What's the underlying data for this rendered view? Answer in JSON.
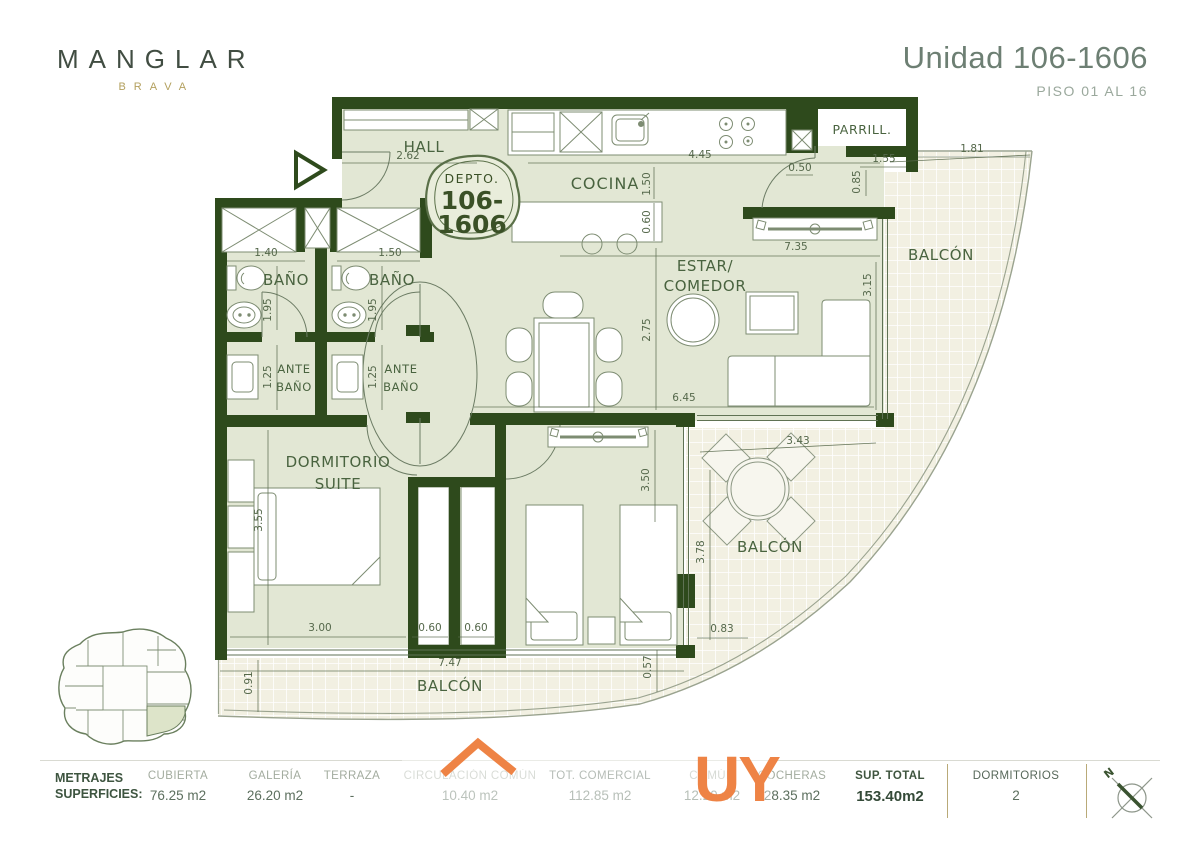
{
  "brand": {
    "name": "MANGLAR",
    "tagline": "BRAVA"
  },
  "header": {
    "title": "Unidad 106-1606",
    "subtitle": "PISO 01 AL 16"
  },
  "badge": {
    "prefix": "DEPTO.",
    "number_line1": "106-",
    "number_line2": "1606"
  },
  "rooms": {
    "hall": "HALL",
    "cocina": "COCINA",
    "parrillero": "PARRILL.",
    "estar_line1": "ESTAR/",
    "estar_line2": "COMEDOR",
    "bano_izq": "BAÑO",
    "bano_der": "BAÑO",
    "antebano_izq_l1": "ANTE",
    "antebano_izq_l2": "BAÑO",
    "antebano_der_l1": "ANTE",
    "antebano_der_l2": "BAÑO",
    "suite_l1": "DORMITORIO",
    "suite_l2": "SUITE",
    "balcon_este": "BALCÓN",
    "balcon_sureste": "BALCÓN",
    "balcon_sur": "BALCÓN"
  },
  "dims": {
    "hall_ancho": "2.62",
    "cocina_ancho": "4.45",
    "cocina_fondo": "1.50",
    "isla_fondo": "0.60",
    "parrillero_paso": "0.50",
    "parrillero_ancho": "1.55",
    "parrillero_fondo": "0.85",
    "balcon_este_ancho": "1.81",
    "estar_ancho": "7.35",
    "estar_fondo": "3.15",
    "comedor_fondo": "2.75",
    "estar_largo": "6.45",
    "bano_izq_ancho": "1.40",
    "bano_der_ancho": "1.50",
    "bano_izq_fondo": "1.95",
    "bano_der_fondo": "1.95",
    "antebano_izq_fondo": "1.25",
    "antebano_der_fondo": "1.25",
    "suite_fondo": "3.55",
    "suite_ancho": "3.00",
    "placard_izq": "0.60",
    "placard_der": "0.60",
    "dorm2_fondo": "3.50",
    "balcon_sur_ancho": "7.47",
    "balcon_sur_alto_izq": "0.91",
    "balcon_sur_alto_der": "0.57",
    "balcon_sureste_ancho": "3.43",
    "balcon_sureste_fondo": "3.78",
    "balcon_sureste_paso": "0.83"
  },
  "compass": {
    "north": "N"
  },
  "watermark": {
    "text": "UY"
  },
  "footer": {
    "heading_l1": "METRAJES",
    "heading_l2": "SUPERFICIES:",
    "columns": [
      {
        "label": "CUBIERTA",
        "value": "76.25 m2"
      },
      {
        "label": "GALERÍA",
        "value": "26.20 m2"
      },
      {
        "label": "TERRAZA",
        "value": "-"
      },
      {
        "label": "CIRCULACIÓN COMÚN",
        "value": "10.40 m2"
      },
      {
        "label": "TOT. COMERCIAL",
        "value": "112.85 m2"
      },
      {
        "label": "COMÚN",
        "value": "12.20 m2"
      },
      {
        "label": "COCHERAS",
        "value": "28.35 m2"
      },
      {
        "label": "SUP. TOTAL",
        "value": "153.40m2"
      },
      {
        "label": "DORMITORIOS",
        "value": "2"
      }
    ]
  },
  "colors": {
    "wall_green": "#2e4a1c",
    "floor_sage": "#e2e7d4",
    "brand_gold": "#b3a05e",
    "watermark_orange": "#ee8345"
  }
}
